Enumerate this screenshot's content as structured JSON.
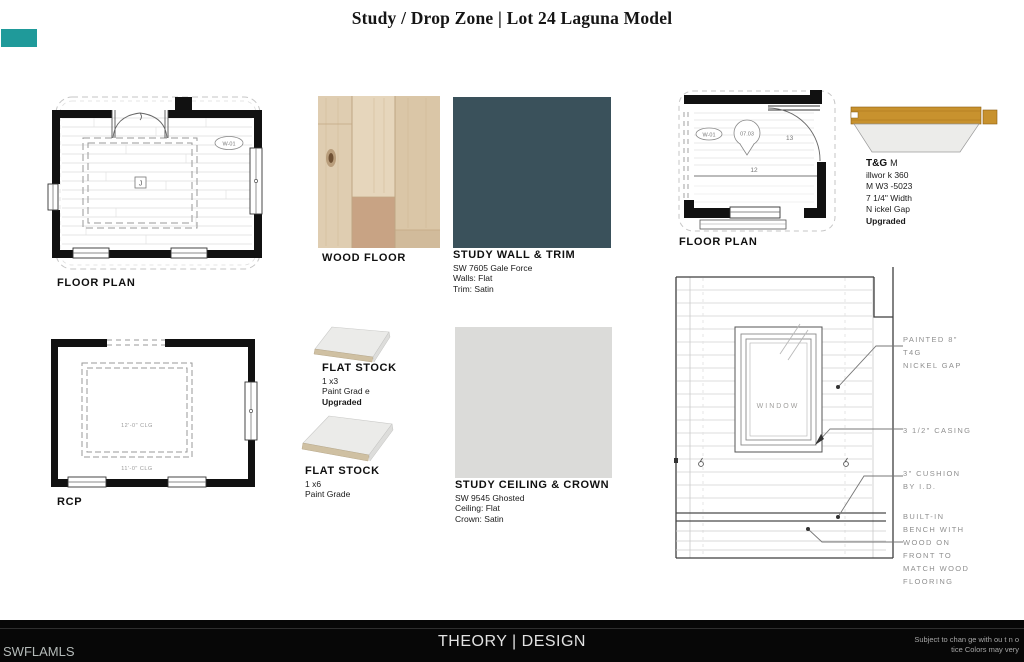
{
  "page": {
    "title": "Study / Drop Zone | Lot 24 Laguna Model"
  },
  "watermark": {
    "color": "#1f9a9a"
  },
  "study_plan": {
    "label": "FLOOR PLAN",
    "window_tag": "W-01",
    "center_tag": "J"
  },
  "wood_floor": {
    "label": "WOOD FLOOR"
  },
  "study_wall": {
    "title": "STUDY WALL & TRIM",
    "lines": [
      "SW 7605 Gale Force",
      "Walls: Flat",
      "Trim: Satin"
    ],
    "swatch_color": "#3a515b"
  },
  "dropzone_plan": {
    "label": "FLOOR PLAN",
    "window_tag": "W-01",
    "detail_tag": "07.03",
    "dim_right": "13",
    "dim_center": "12"
  },
  "tg": {
    "title_bold": "T&G",
    "title_suffix": "M",
    "lines": [
      "illwor k 360",
      "M W3 -5023",
      "7 1/4\" Width",
      "N ickel Gap"
    ],
    "upgrade": "Upgraded"
  },
  "rcp": {
    "label": "RCP",
    "clg_main": "12'-0\" CLG",
    "clg_entry": "11'-0\" CLG"
  },
  "flat_stock_1x3": {
    "title": "FLAT STOCK",
    "lines": [
      "1 x3",
      "Paint Grad e"
    ],
    "upgrade": "Upgraded"
  },
  "flat_stock_1x6": {
    "title": "FLAT STOCK",
    "lines": [
      "1 x6",
      "Paint Grade"
    ]
  },
  "study_ceiling": {
    "title": "STUDY CEILING & CROWN",
    "lines": [
      "SW 9545 Ghosted",
      "Ceiling: Flat",
      "Crown: Satin"
    ],
    "swatch_color": "#dbdbd9"
  },
  "elevation": {
    "window_label": "WINDOW",
    "annotations": [
      {
        "lines": [
          "PAINTED 8\"",
          "T4G",
          "NICKEL GAP"
        ]
      },
      {
        "lines": [
          "3 1/2\" CASING"
        ]
      },
      {
        "lines": [
          "3\" CUSHION",
          "BY I.D."
        ]
      },
      {
        "lines": [
          "BUILT-IN",
          "BENCH WITH",
          "WOOD ON",
          "FRONT TO",
          "MATCH WOOD",
          "FLOORING"
        ]
      }
    ]
  },
  "footer": {
    "mls": "SWFLAMLS",
    "brand": "THEORY | DESIGN",
    "disclaimer": [
      "Subject to chan ge with ou t n o",
      "tice Colors may very"
    ]
  }
}
